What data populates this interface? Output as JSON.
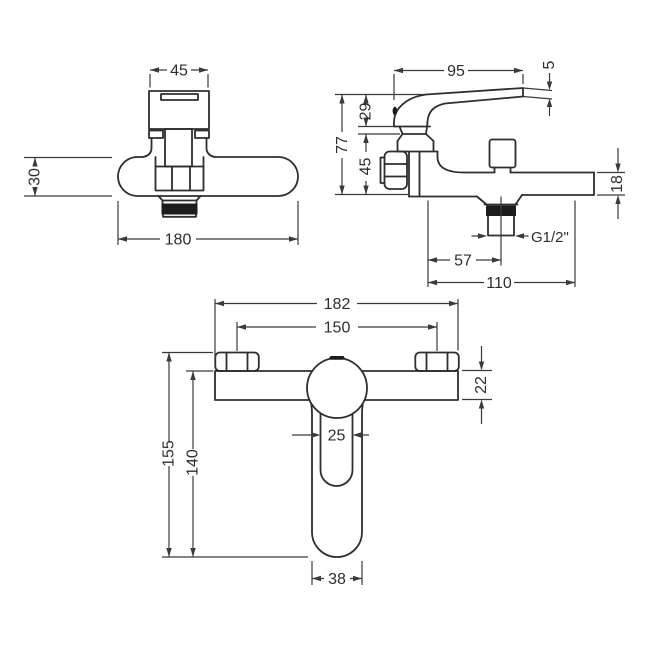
{
  "drawing": {
    "background": "#ffffff",
    "line_color": "#2e2e2e",
    "views": {
      "front": {
        "name": "front view",
        "dims": {
          "handle_width": "45",
          "body_height": "30",
          "overall_width": "180"
        }
      },
      "side": {
        "name": "side view",
        "dims": {
          "lever_length": "95",
          "lever_thickness": "5",
          "overall_height": "77",
          "upper_height": "29",
          "lower_height": "45",
          "spout_depth": "18",
          "outlet_thread": "G1/2\"",
          "wall_to_outlet": "57",
          "overall_projection": "110"
        }
      },
      "top": {
        "name": "top view",
        "dims": {
          "overall_width": "182",
          "fixing_centres": "150",
          "body_depth": "22",
          "handle_neck_width": "25",
          "overall_drop": "155",
          "handle_drop": "140",
          "handle_end_width": "38"
        }
      }
    }
  }
}
